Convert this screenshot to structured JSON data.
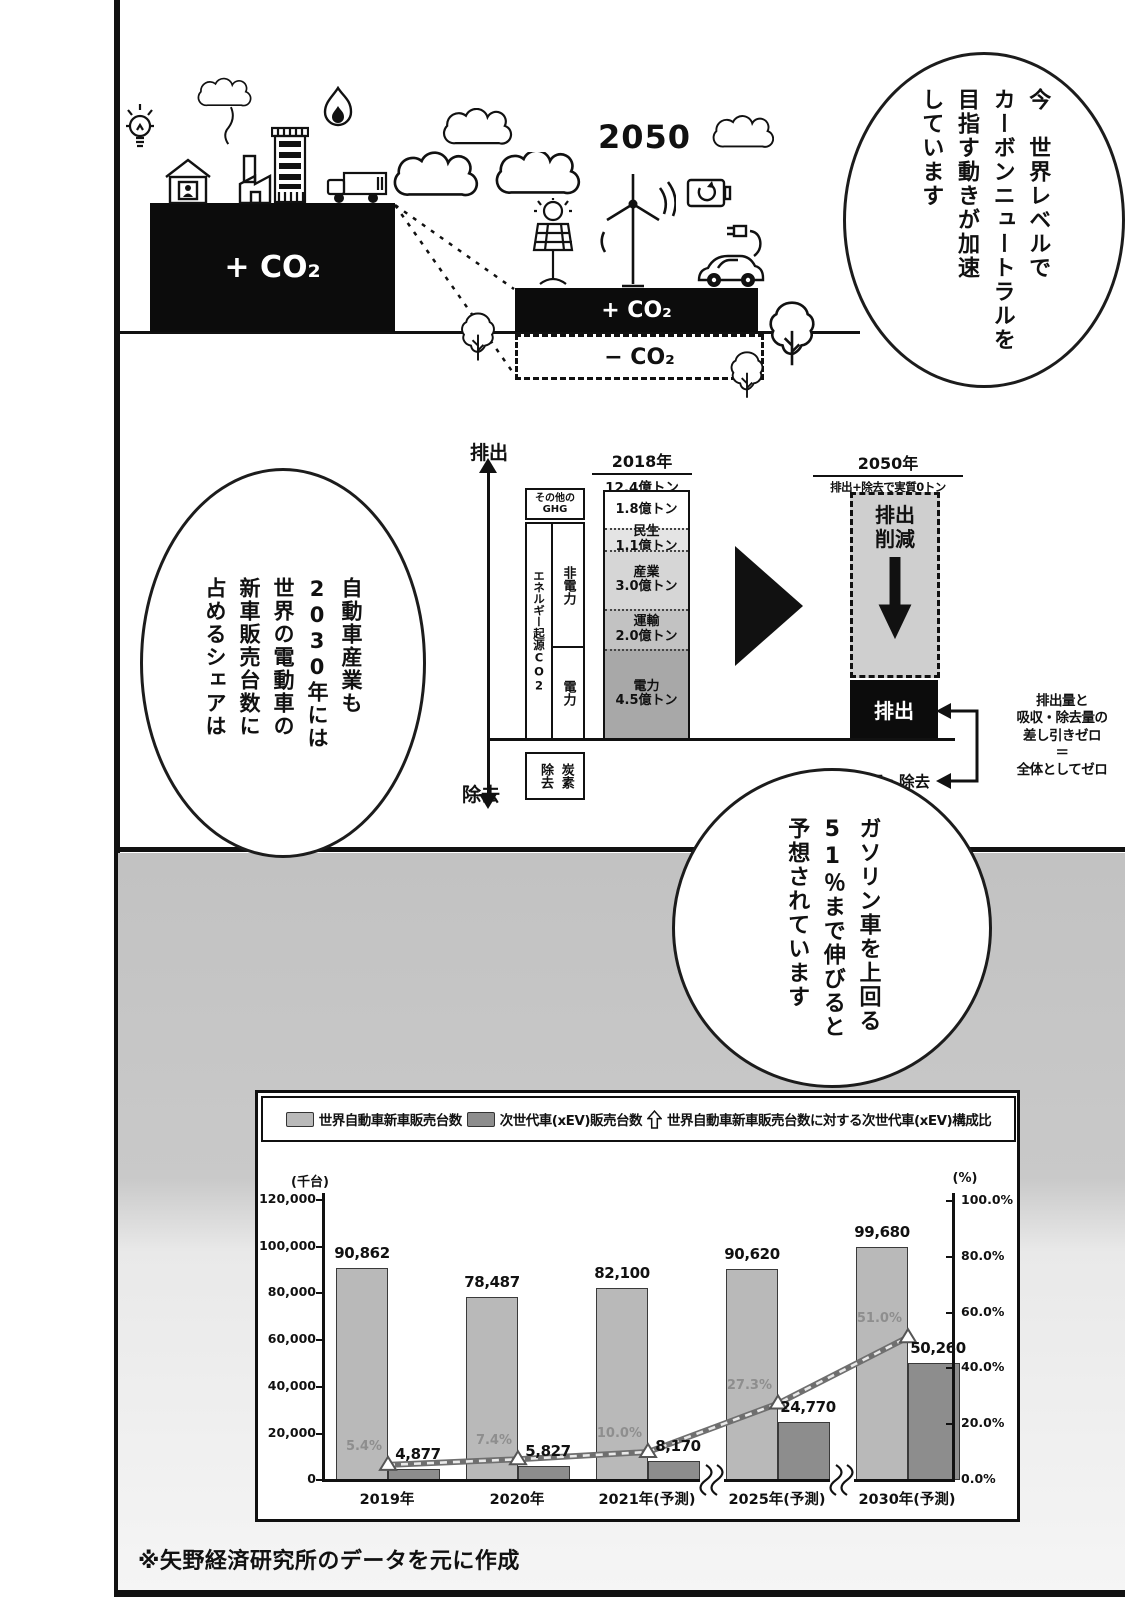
{
  "page": {
    "source_note": "※矢野経済研究所のデータを元に作成"
  },
  "illustration": {
    "year_label": "2050",
    "now_co2": "+ CO₂",
    "future_co2_plus": "+ CO₂",
    "future_co2_minus": "− CO₂"
  },
  "bubbles": {
    "world": {
      "lines": [
        "今　世界レベルで",
        "カーボンニュートラルを",
        "目指す動きが加速",
        "しています"
      ]
    },
    "auto": {
      "lines": [
        "自動車産業も",
        "2030年には",
        "世界の電動車の",
        "新車販売台数に",
        "占めるシェアは"
      ]
    },
    "gasoline": {
      "lines": [
        "ガソリン車を上回る",
        "51％まで伸びると",
        "予想されています"
      ]
    }
  },
  "diagram": {
    "axis_top_label": "排出",
    "axis_bottom_label": "除去",
    "left_labels": {
      "other_ghg_line1": "その他の",
      "other_ghg_line2": "GHG",
      "energy_co2": "エネルギー起源CO2",
      "non_power": "非電力",
      "power": "電力",
      "carbon_removal_line1": "炭素",
      "carbon_removal_line2": "除去"
    },
    "y2018": {
      "header": "2018年",
      "subheader": "12.4億トン",
      "total": 12.4,
      "segments": [
        {
          "name": "",
          "value": "1.8億トン",
          "amount": 1.8,
          "color": "#ffffff"
        },
        {
          "name": "民生",
          "value": "1.1億トン",
          "amount": 1.1,
          "color": "#e4e4e4"
        },
        {
          "name": "産業",
          "value": "3.0億トン",
          "amount": 3.0,
          "color": "#d6d6d6"
        },
        {
          "name": "運輸",
          "value": "2.0億トン",
          "amount": 2.0,
          "color": "#c2c2c2"
        },
        {
          "name": "電力",
          "value": "4.5億トン",
          "amount": 4.5,
          "color": "#a8a8a8"
        }
      ]
    },
    "y2050": {
      "header": "2050年",
      "subheader": "排出+除去で実質0トン",
      "reduction_line1": "排出",
      "reduction_line2": "削減",
      "emission_label": "排出",
      "absorption_label": "吸収・除去"
    },
    "note_lines": [
      "排出量と",
      "吸収・除去量の",
      "差し引きゼロ",
      "＝",
      "全体としてゼロ"
    ]
  },
  "chart_data": {
    "type": "bar",
    "categories": [
      "2019年",
      "2020年",
      "2021年(予測)",
      "2025年(予測)",
      "2030年(予測)"
    ],
    "series": [
      {
        "name": "世界自動車新車販売台数",
        "type": "bar",
        "axis": "left",
        "color": "#b9b9b9",
        "values": [
          90862,
          78487,
          82100,
          90620,
          99680
        ],
        "labels": [
          "90,862",
          "78,487",
          "82,100",
          "90,620",
          "99,680"
        ]
      },
      {
        "name": "次世代車(xEV)販売台数",
        "type": "bar",
        "axis": "left",
        "color": "#8d8d8d",
        "values": [
          4877,
          5827,
          8170,
          24770,
          50260
        ],
        "labels": [
          "4,877",
          "5,827",
          "8,170",
          "24,770",
          "50,260"
        ]
      },
      {
        "name": "世界自動車新車販売台数に対する次世代車(xEV)構成比",
        "type": "line",
        "axis": "right",
        "values": [
          5.4,
          7.4,
          10.0,
          27.3,
          51.0
        ],
        "labels": [
          "5.4%",
          "7.4%",
          "10.0%",
          "27.3%",
          "51.0%"
        ]
      }
    ],
    "left_axis": {
      "unit": "(千台)",
      "max": 120000,
      "ticks": [
        "120,000",
        "100,000",
        "80,000",
        "60,000",
        "40,000",
        "20,000",
        "0"
      ]
    },
    "right_axis": {
      "unit": "(%)",
      "max": 100,
      "ticks": [
        "100.0%",
        "80.0%",
        "60.0%",
        "40.0%",
        "20.0%",
        "0.0%"
      ]
    },
    "x_axis_breaks_after": [
      2,
      3
    ],
    "legend_position": "top",
    "grid": false
  }
}
